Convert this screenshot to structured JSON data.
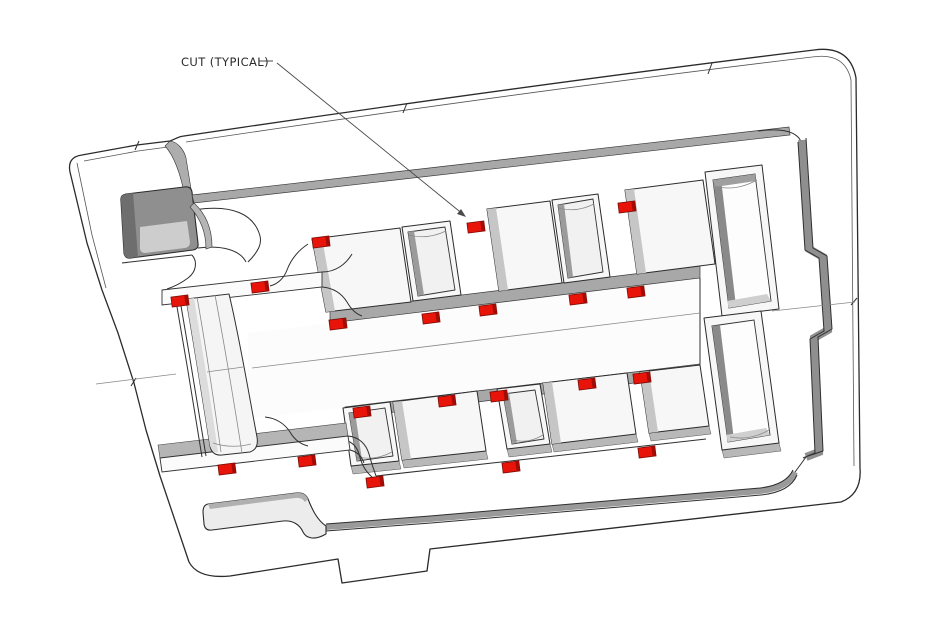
{
  "annotation": {
    "label": "CUT (TYPICAL)",
    "label_x": 181,
    "label_y": 66,
    "dash": {
      "x1": 259,
      "y1": 61,
      "x2": 273,
      "y2": 61
    },
    "leader": {
      "x1": 277,
      "y1": 63,
      "x2": 464,
      "y2": 215
    },
    "arrowhead_points": "466,217 457,214 461,209"
  },
  "colors": {
    "background": "#ffffff",
    "cut_red": "#e8140a",
    "cut_red_dark": "#a30c05",
    "cut_red_outline": "#7a0b06",
    "outline": "#2b2b2b",
    "wall_gray": "#a8a8a8",
    "floor_gray": "#c9c9c9",
    "annotation_gray": "#4a4a4a"
  },
  "cut_mark_style": {
    "width": 17,
    "height": 10,
    "angle": -7.3
  },
  "cut_marks": [
    {
      "x": 180,
      "y": 301
    },
    {
      "x": 260,
      "y": 287
    },
    {
      "x": 321,
      "y": 242
    },
    {
      "x": 476,
      "y": 227
    },
    {
      "x": 627,
      "y": 207
    },
    {
      "x": 338,
      "y": 324
    },
    {
      "x": 431,
      "y": 318
    },
    {
      "x": 488,
      "y": 310
    },
    {
      "x": 578,
      "y": 299
    },
    {
      "x": 636,
      "y": 292
    },
    {
      "x": 362,
      "y": 412
    },
    {
      "x": 447,
      "y": 401
    },
    {
      "x": 499,
      "y": 396
    },
    {
      "x": 587,
      "y": 384
    },
    {
      "x": 642,
      "y": 378
    },
    {
      "x": 227,
      "y": 469
    },
    {
      "x": 307,
      "y": 461
    },
    {
      "x": 375,
      "y": 482
    },
    {
      "x": 511,
      "y": 467
    },
    {
      "x": 647,
      "y": 452
    }
  ],
  "canvas": {
    "width": 947,
    "height": 625
  }
}
